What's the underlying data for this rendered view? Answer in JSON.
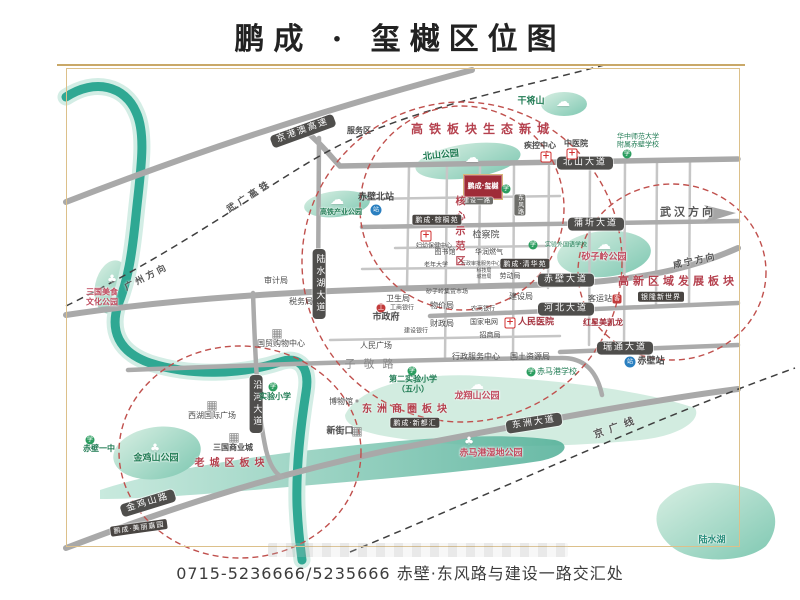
{
  "title": "鹏成 · 玺樾区位图",
  "footer": "0715-5236666/5235666 赤壁·东风路与建设一路交汇处",
  "palette": {
    "river": "#2fa893",
    "road": "#a9a9a9",
    "road_badge_bg": "#4f4e4c",
    "zone_red": "#b5414e",
    "park_green": "#1e7a52",
    "gold_frame": "#c9a868",
    "logo_red": "#9f2c38",
    "circle_red": "#c0504d"
  },
  "logo": {
    "text": "鹏成·玺樾"
  },
  "road_badges": [
    {
      "id": "jinggangao-expressway",
      "t": "京港澳高速",
      "x": 303,
      "y": 131,
      "rot": -20
    },
    {
      "id": "beishan-avenue",
      "t": "北山大道",
      "x": 585,
      "y": 163
    },
    {
      "id": "puqi-avenue",
      "t": "蒲圻大道",
      "x": 596,
      "y": 224
    },
    {
      "id": "chibi-avenue",
      "t": "赤壁大道",
      "x": 566,
      "y": 280
    },
    {
      "id": "hebei-avenue",
      "t": "河北大道",
      "x": 566,
      "y": 309
    },
    {
      "id": "ruitong-avenue",
      "t": "瑞通大道",
      "x": 625,
      "y": 348
    },
    {
      "id": "dongzhou-avenue",
      "t": "东洲大道",
      "x": 534,
      "y": 423,
      "rot": -9
    },
    {
      "id": "jinjishan-road",
      "t": "金鸡山路",
      "x": 148,
      "y": 503,
      "rot": -17
    },
    {
      "id": "yanhe-avenue",
      "t": "沿河大道",
      "x": 256,
      "y": 404,
      "vert": 1
    },
    {
      "id": "lushuihu-avenue",
      "t": "陆水湖大道",
      "x": 319,
      "y": 284,
      "vert": 1
    },
    {
      "id": "jianshe-yilu",
      "t": "建设一路",
      "x": 477,
      "y": 201,
      "small": 1
    },
    {
      "id": "dongfeng-road",
      "t": "东风路",
      "x": 520,
      "y": 205,
      "vert": 1,
      "small": 1
    }
  ],
  "zones": [
    {
      "id": "gaotie-eco-newtown",
      "t": "高铁板块生态新城",
      "x": 483,
      "y": 129,
      "fs": 12,
      "ls": 6
    },
    {
      "id": "gaoxin-development",
      "t": "高新区域发展板块",
      "x": 678,
      "y": 281,
      "fs": 11,
      "ls": 4
    },
    {
      "id": "dongzhou-business",
      "t": "东洲商圈板块",
      "x": 407,
      "y": 410,
      "fs": 10,
      "ls": 5
    },
    {
      "id": "old-town",
      "t": "老城区板块",
      "x": 232,
      "y": 464,
      "fs": 10,
      "ls": 5
    },
    {
      "id": "core-demo-area",
      "t": "核心示范区",
      "x": 458,
      "y": 233,
      "fs": 10,
      "ls": 5,
      "vert": 1
    }
  ],
  "parks": [
    {
      "id": "beishan-park",
      "t": "北山公园",
      "x": 441,
      "y": 156,
      "c": "g",
      "rot": -6,
      "ck": "cloud",
      "cx": 472,
      "cy": 158
    },
    {
      "id": "gaotie-industry-park",
      "t": "高铁产业公园",
      "x": 341,
      "y": 212,
      "c": "g",
      "fs": 7,
      "ck": "cloud",
      "cx": 337,
      "cy": 200
    },
    {
      "id": "shaziling-park",
      "t": "砂子岭公园",
      "x": 604,
      "y": 258,
      "c": "r",
      "ck": "cloud",
      "cx": 604,
      "cy": 245
    },
    {
      "id": "jinjishan-park",
      "t": "金鸡山公园",
      "x": 156,
      "y": 459,
      "c": "g",
      "ck": "tree",
      "cx": 155,
      "cy": 448
    },
    {
      "id": "longxiangshan-park",
      "t": "龙翔山公园",
      "x": 477,
      "y": 397,
      "c": "r",
      "ck": "cloud",
      "cx": 477,
      "cy": 385
    },
    {
      "id": "chimagang-wetland-park",
      "t": "赤马港湿地公园",
      "x": 491,
      "y": 454,
      "c": "r",
      "ck": "tree",
      "cx": 469,
      "cy": 441
    },
    {
      "id": "sanguo-food-culture-park",
      "t": "三国美食\n文化公园",
      "x": 102,
      "y": 297,
      "c": "r",
      "fs": 8,
      "ck": "tree",
      "cx": 112,
      "cy": 279
    },
    {
      "id": "ganjiangshan",
      "t": "干将山",
      "x": 531,
      "y": 102,
      "c": "g",
      "ck": "cloud",
      "cx": 563,
      "cy": 102
    },
    {
      "id": "lushui-lake",
      "t": "陆水湖",
      "x": 712,
      "y": 541,
      "c": "t"
    }
  ],
  "pois": [
    {
      "id": "huazhong-normal-affiliated-school",
      "t": "华中师范大学\n附属赤壁学校",
      "x": 638,
      "y": 141,
      "fs": 7,
      "c": "g",
      "ik": "school",
      "ix": 627,
      "iy": 154
    },
    {
      "id": "shiyan-primary-school",
      "t": "实验小学",
      "x": 275,
      "y": 397,
      "fs": 8,
      "c": "g",
      "b": 1,
      "ik": "school",
      "ix": 273,
      "iy": 387
    },
    {
      "id": "chibi-no1-middle-school",
      "t": "赤壁一中",
      "x": 99,
      "y": 449,
      "fs": 8,
      "c": "g",
      "b": 1,
      "ik": "school",
      "ix": 90,
      "iy": 440
    },
    {
      "id": "no2-experimental-primary",
      "t": "第二实验小学\n（五小）",
      "x": 413,
      "y": 384,
      "fs": 8,
      "c": "g",
      "b": 1,
      "ik": "school",
      "ix": 412,
      "iy": 371
    },
    {
      "id": "chimagang-school",
      "t": "赤马港学校",
      "x": 557,
      "y": 372,
      "fs": 8,
      "c": "g",
      "ik": "school",
      "ix": 531,
      "iy": 372
    },
    {
      "id": "experimental-foreign-language-school",
      "t": "实验外国语学校",
      "x": 566,
      "y": 245,
      "fs": 6,
      "c": "g",
      "ik": "school",
      "ix": 533,
      "iy": 245
    },
    {
      "id": "kindergarten",
      "t": "",
      "x": 506,
      "y": 189,
      "ik": "school",
      "ix": 506,
      "iy": 189
    },
    {
      "id": "cdc-center",
      "t": "疾控中心",
      "x": 540,
      "y": 146,
      "fs": 8,
      "b": 1,
      "ik": "hosp",
      "ix": 546,
      "iy": 157
    },
    {
      "id": "tcm-hospital",
      "t": "中医院",
      "x": 576,
      "y": 144,
      "fs": 8,
      "b": 1,
      "ik": "hosp",
      "ix": 572,
      "iy": 154
    },
    {
      "id": "peoples-hospital",
      "t": "人民医院",
      "x": 536,
      "y": 323,
      "fs": 9,
      "c": "dr",
      "b": 1,
      "ik": "hosp",
      "ix": 510,
      "iy": 323
    },
    {
      "id": "maternal-health-center",
      "t": "妇幼保健中心",
      "x": 434,
      "y": 246,
      "fs": 6,
      "ik": "hosp",
      "ix": 426,
      "iy": 236
    },
    {
      "id": "chibi-north-station",
      "t": "赤壁北站",
      "x": 376,
      "y": 198,
      "fs": 9,
      "b": 1,
      "ik": "train",
      "ix": 376,
      "iy": 210
    },
    {
      "id": "chibi-station",
      "t": "赤壁站",
      "x": 651,
      "y": 362,
      "fs": 9,
      "b": 1,
      "ik": "train",
      "ix": 630,
      "iy": 362
    },
    {
      "id": "bus-terminal",
      "t": "客运站",
      "x": 600,
      "y": 299,
      "fs": 8,
      "ik": "bus",
      "ix": 617,
      "iy": 299
    },
    {
      "id": "guomao-shopping-center",
      "t": "国贸购物中心",
      "x": 281,
      "y": 344,
      "fs": 8,
      "ik": "bld",
      "ix": 277,
      "iy": 333
    },
    {
      "id": "xihu-international-plaza",
      "t": "西湖国际广场",
      "x": 212,
      "y": 416,
      "fs": 8,
      "ik": "bld",
      "ix": 212,
      "iy": 405
    },
    {
      "id": "sanguo-commercial-city",
      "t": "三国商业城",
      "x": 233,
      "y": 448,
      "fs": 8,
      "b": 1,
      "ik": "bld",
      "ix": 234,
      "iy": 437
    },
    {
      "id": "xinjiekou",
      "t": "新街口",
      "x": 340,
      "y": 432,
      "fs": 9,
      "b": 1,
      "ik": "bld",
      "ix": 357,
      "iy": 431
    },
    {
      "id": "museum",
      "t": "博物馆",
      "x": 341,
      "y": 402,
      "fs": 8,
      "ik": "dot",
      "ix": 357,
      "iy": 401
    },
    {
      "id": "icbc-bank",
      "t": "工商银行",
      "x": 402,
      "y": 308,
      "fs": 6,
      "ik": "bank",
      "ix": 381,
      "iy": 308
    },
    {
      "id": "ccb-bank",
      "t": "建设银行",
      "x": 416,
      "y": 331,
      "fs": 6
    },
    {
      "id": "rural-commercial-bank",
      "t": "农商银行",
      "x": 483,
      "y": 309,
      "fs": 6
    },
    {
      "id": "audit-bureau",
      "t": "审计局",
      "x": 276,
      "y": 281,
      "fs": 8
    },
    {
      "id": "tax-bureau",
      "t": "税务局",
      "x": 301,
      "y": 302,
      "fs": 8
    },
    {
      "id": "city-government",
      "t": "市政府",
      "x": 386,
      "y": 318,
      "fs": 9,
      "b": 1
    },
    {
      "id": "price-bureau",
      "t": "物价局",
      "x": 442,
      "y": 306,
      "fs": 8
    },
    {
      "id": "finance-bureau",
      "t": "财政局",
      "x": 442,
      "y": 324,
      "fs": 8
    },
    {
      "id": "state-grid",
      "t": "国家电网",
      "x": 484,
      "y": 322,
      "fs": 7
    },
    {
      "id": "investment-bureau",
      "t": "招商局",
      "x": 490,
      "y": 335,
      "fs": 7
    },
    {
      "id": "peoples-square",
      "t": "人民广场",
      "x": 376,
      "y": 346,
      "fs": 8
    },
    {
      "id": "admin-service-center",
      "t": "行政服务中心",
      "x": 476,
      "y": 357,
      "fs": 8
    },
    {
      "id": "land-resources-bureau",
      "t": "国土资源局",
      "x": 530,
      "y": 357,
      "fs": 8
    },
    {
      "id": "health-bureau",
      "t": "卫生局",
      "x": 398,
      "y": 299,
      "fs": 8
    },
    {
      "id": "shaziling-market",
      "t": "砂子岭集贸市场",
      "x": 447,
      "y": 292,
      "fs": 6
    },
    {
      "id": "construction-bureau",
      "t": "建设局",
      "x": 521,
      "y": 297,
      "fs": 8
    },
    {
      "id": "labor-bureau",
      "t": "劳动局",
      "x": 510,
      "y": 276,
      "fs": 7
    },
    {
      "id": "procuratorate",
      "t": "检察院",
      "x": 486,
      "y": 236,
      "fs": 9
    },
    {
      "id": "huarun-gas",
      "t": "华润燃气",
      "x": 489,
      "y": 252,
      "fs": 7
    },
    {
      "id": "library",
      "t": "图书馆",
      "x": 445,
      "y": 252,
      "fs": 7
    },
    {
      "id": "senior-university",
      "t": "老年大学",
      "x": 436,
      "y": 265,
      "fs": 6
    },
    {
      "id": "admin-approval-center",
      "t": "行政审批服务中心",
      "x": 481,
      "y": 264,
      "fs": 5
    },
    {
      "id": "science-bureau",
      "t": "科技局",
      "x": 484,
      "y": 271,
      "fs": 5
    },
    {
      "id": "urban-management-bureau",
      "t": "城管局",
      "x": 484,
      "y": 277,
      "fs": 5
    },
    {
      "id": "redstar-macalline",
      "t": "红星美凯龙",
      "x": 603,
      "y": 323,
      "fs": 8,
      "c": "dr",
      "b": 1
    },
    {
      "id": "service-area",
      "t": "服务区",
      "x": 359,
      "y": 131,
      "fs": 8,
      "b": 1
    },
    {
      "id": "zijing-road",
      "t": "子敬路",
      "x": 373,
      "y": 364,
      "fs": 11,
      "ls": 8,
      "c": "gray"
    }
  ],
  "projects": [
    {
      "id": "zonglvyuan",
      "t": "鹏成·棕榈苑",
      "x": 437,
      "y": 220
    },
    {
      "id": "qinghuayuan",
      "t": "鹏成·清华苑",
      "x": 525,
      "y": 264
    },
    {
      "id": "xinduhui",
      "t": "鹏成·新都汇",
      "x": 415,
      "y": 423
    },
    {
      "id": "meilijiayuan",
      "t": "鹏成·美丽嘉园",
      "x": 139,
      "y": 528,
      "rot": -8
    },
    {
      "id": "yinlong-xinshijie",
      "t": "银隆新世界",
      "x": 661,
      "y": 297
    }
  ],
  "directions": [
    {
      "id": "to-wuhan",
      "t": "武汉方向",
      "x": 688,
      "y": 212,
      "fs": 11,
      "ls": 3,
      "b": 1
    },
    {
      "id": "to-xianning",
      "t": "咸宁方向",
      "x": 695,
      "y": 262,
      "fs": 9,
      "ls": 2,
      "rot": -12
    },
    {
      "id": "to-guangzhou",
      "t": "广州方向",
      "x": 147,
      "y": 278,
      "fs": 9,
      "ls": 3,
      "rot": -27
    },
    {
      "id": "wuguang-hsr",
      "t": "武广高铁",
      "x": 250,
      "y": 197,
      "fs": 9,
      "ls": 4,
      "rot": -33
    },
    {
      "id": "jingguang-line",
      "t": "京广线",
      "x": 617,
      "y": 428,
      "fs": 10,
      "ls": 6,
      "rot": -20
    }
  ]
}
